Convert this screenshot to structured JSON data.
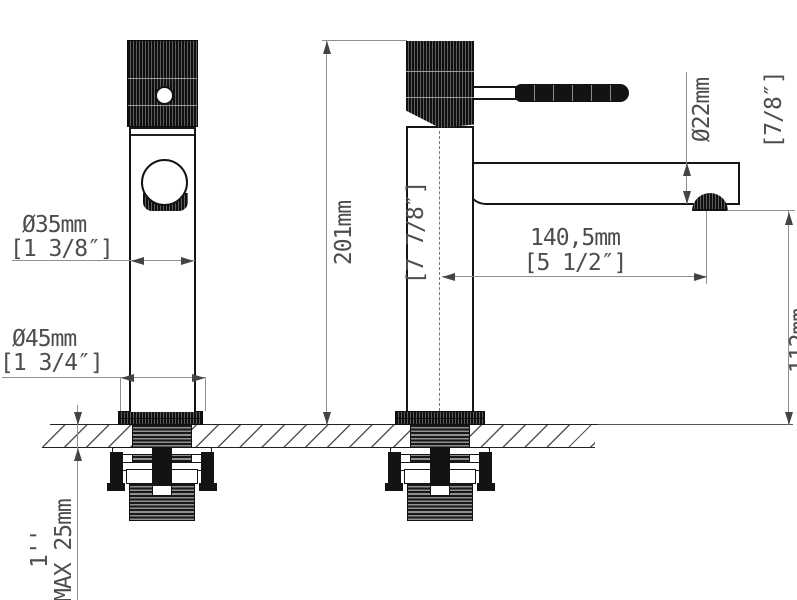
{
  "dimensions": {
    "body_diameter": {
      "metric": "Ø35mm",
      "imperial": "[1 3/8″]"
    },
    "base_diameter": {
      "metric": "Ø45mm",
      "imperial": "[1 3/4″]"
    },
    "total_height": {
      "metric": "201mm",
      "imperial": "[7 7/8″]"
    },
    "spout_diameter": {
      "metric": "Ø22mm",
      "imperial": "[7/8″]"
    },
    "spout_reach": {
      "metric": "140,5mm",
      "imperial": "[5 1/2″]"
    },
    "outlet_height": {
      "metric": "112mm",
      "imperial": "[4 3/8″]"
    },
    "mounting": {
      "thread_size": "1''",
      "max_deck_thickness": "MAX 25mm"
    }
  },
  "colors": {
    "outline": "#151515",
    "dimension_line": "#8f8f8f",
    "text": "#4d4d4d",
    "hatch": "#555555"
  }
}
